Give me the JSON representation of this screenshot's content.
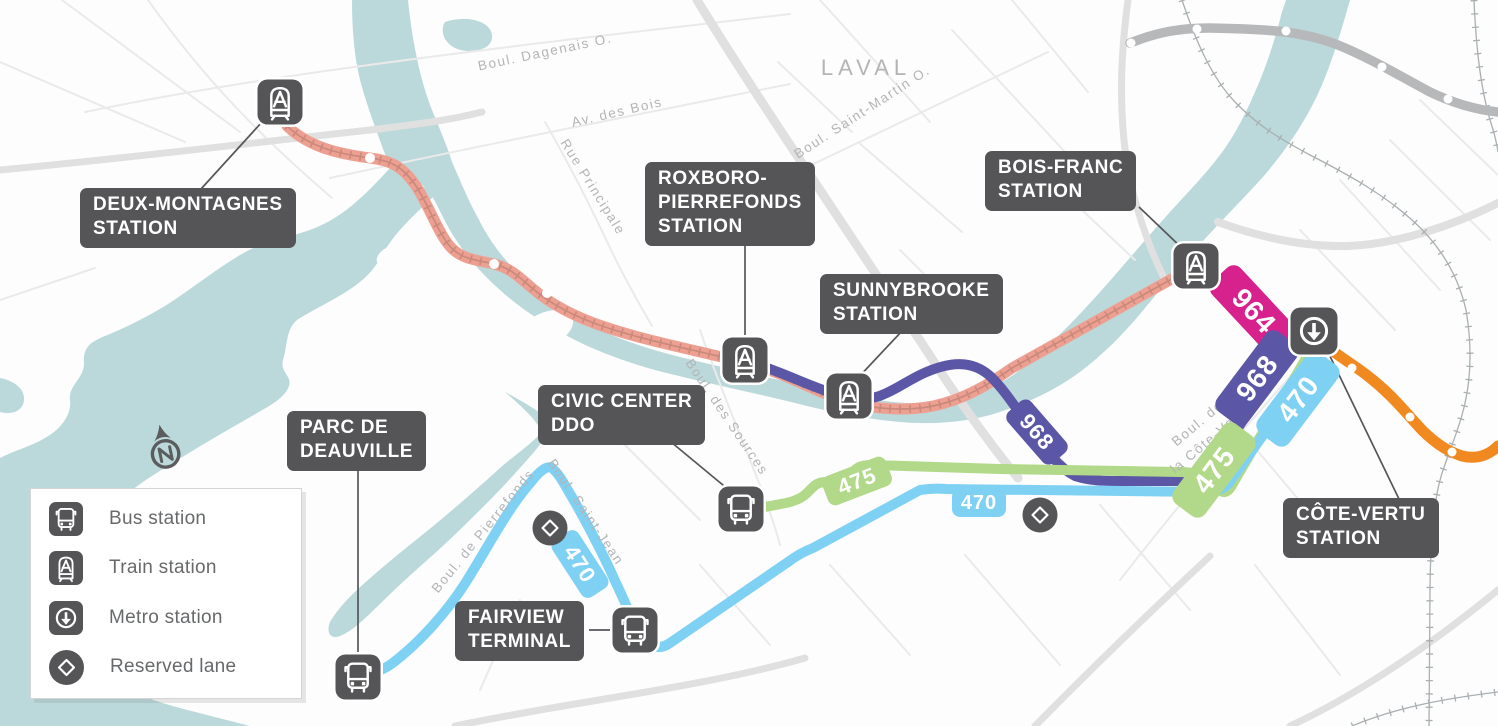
{
  "legend": {
    "items": [
      {
        "icon": "bus-icon",
        "label": "Bus station"
      },
      {
        "icon": "train-icon",
        "label": "Train station"
      },
      {
        "icon": "metro-icon",
        "label": "Metro station"
      },
      {
        "icon": "reserved-lane-icon",
        "label": "Reserved lane"
      }
    ]
  },
  "stations": {
    "deux_montagnes": {
      "name": "DEUX-MONTAGNES\nSTATION",
      "type": "train"
    },
    "roxboro_pierrefonds": {
      "name": "ROXBORO-\nPIERREFONDS\nSTATION",
      "type": "train"
    },
    "sunnybrooke": {
      "name": "SUNNYBROOKE\nSTATION",
      "type": "train"
    },
    "bois_franc": {
      "name": "BOIS-FRANC\nSTATION",
      "type": "train"
    },
    "civic_center_ddo": {
      "name": "CIVIC CENTER\nDDO",
      "type": "bus"
    },
    "parc_de_deauville": {
      "name": "PARC DE\nDEAUVILLE",
      "type": "bus"
    },
    "fairview_terminal": {
      "name": "FAIRVIEW\nTERMINAL",
      "type": "bus"
    },
    "cote_vertu": {
      "name": "CÔTE-VERTU\nSTATION",
      "type": "metro"
    }
  },
  "routes": {
    "bus_964": {
      "number": "964",
      "color": "#d7218d"
    },
    "bus_968": {
      "number": "968",
      "color": "#5b57a6"
    },
    "bus_470": {
      "number": "470",
      "color": "#7fd1f4"
    },
    "bus_475": {
      "number": "475",
      "color": "#b2d989"
    },
    "train_line": {
      "color": "#eda092"
    },
    "metro_line": {
      "color": "#f0891f"
    },
    "secondary_transit_line": {
      "color": "#b6b8ba"
    }
  },
  "map": {
    "region": "LAVAL",
    "compass": "N",
    "streets": {
      "dagenais": "Boul. Dagenais O.",
      "des_bois": "Av. des Bois",
      "principale": "Rue Principale",
      "saint_martin": "Boul. Saint-Martin O.",
      "des_sources": "Boul. des Sources",
      "pierrefonds": "Boul. de Pierrefonds",
      "saint_jean": "Boul. Saint-Jean",
      "cote_vertu": "Boul. de\nla Côte-Vertu"
    },
    "colors": {
      "water": "#bbd9db",
      "label_box": "#555557",
      "road": "#eaeaea"
    }
  }
}
